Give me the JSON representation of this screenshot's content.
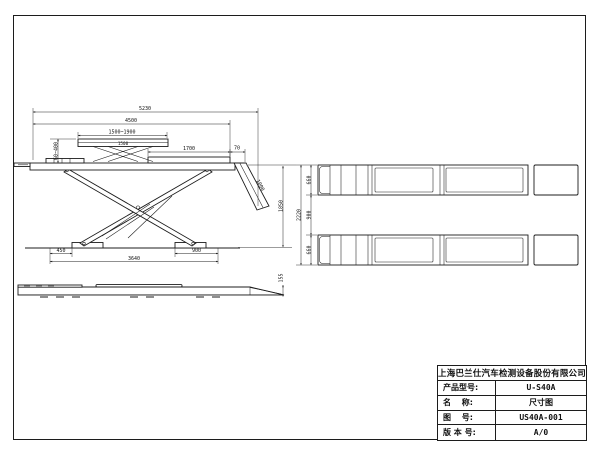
{
  "title_block": {
    "company": "上海巴兰仕汽车检测设备股份有限公司",
    "rows": [
      {
        "label": "产品型号:",
        "value": "U-S40A"
      },
      {
        "label": "名　 称:",
        "value": "尺寸图"
      },
      {
        "label": "图　 号:",
        "value": "US40A-001"
      },
      {
        "label": "版 本 号:",
        "value": "A/0"
      }
    ]
  },
  "dims": {
    "overall_length": "5230",
    "platform_length": "4500",
    "aux_range": "1500~1900",
    "aux_inner": "1500",
    "rear_flat": "1700",
    "ramp_top": "70",
    "aux_travel": "60~400",
    "ramp_len": "1000",
    "lift_height": "1850",
    "base_left": "450",
    "base_right": "900",
    "base_len": "3640",
    "min_height": "155",
    "runway_w_top": "660",
    "track_gap": "900",
    "runway_w_bot": "660",
    "overall_width": "2220"
  }
}
